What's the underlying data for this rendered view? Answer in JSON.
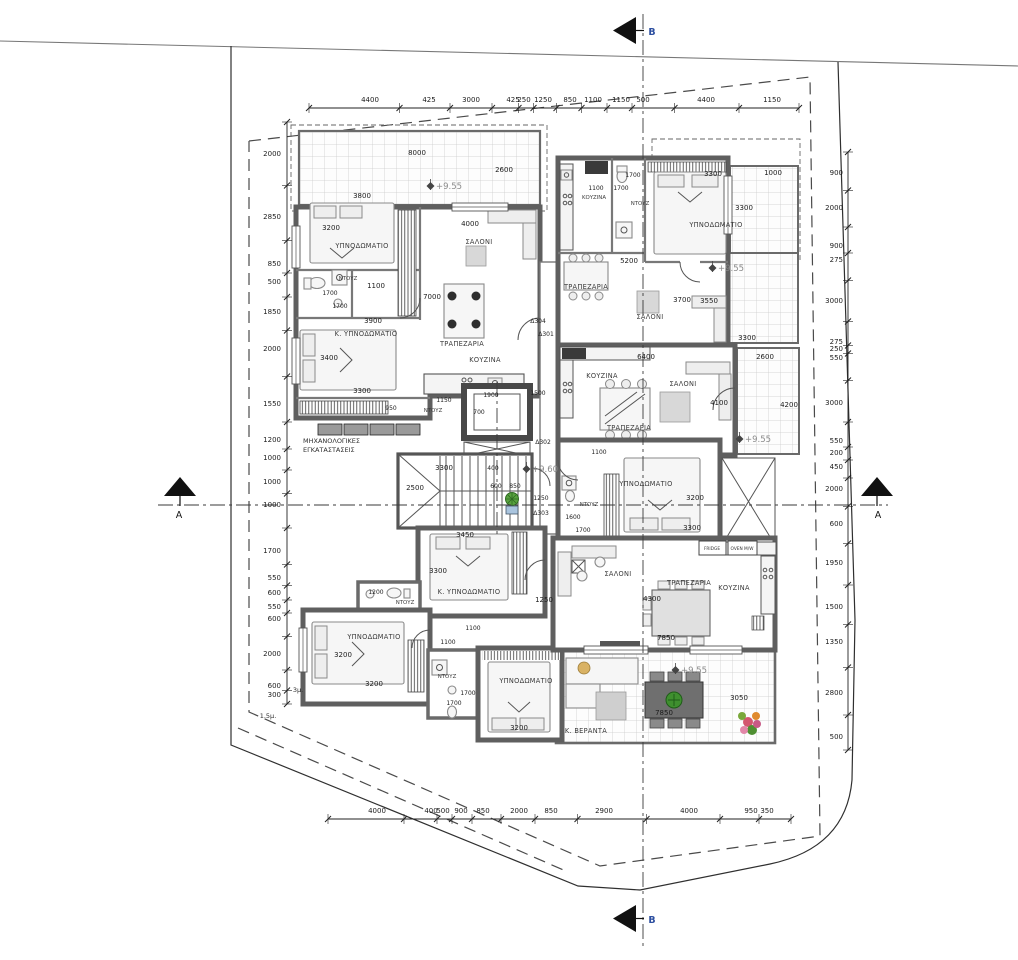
{
  "section_markers": {
    "top": "B",
    "bottom": "B",
    "left": "A",
    "right": "A"
  },
  "levels": [
    "+9.55",
    "+9.55",
    "+9.55",
    "+9.55",
    "+9.60"
  ],
  "door_tags": [
    "Δ304",
    "Δ301",
    "Δ302",
    "Δ303"
  ],
  "chains": {
    "top": {
      "o": "h",
      "line": 108,
      "lp": 102,
      "from": 309,
      "to": 799,
      "labels": [
        {
          "t": "4400",
          "p": 370
        },
        {
          "t": "425",
          "p": 429
        },
        {
          "t": "3000",
          "p": 471
        },
        {
          "t": "425",
          "p": 513
        },
        {
          "t": "250",
          "p": 524
        },
        {
          "t": "1250",
          "p": 543
        },
        {
          "t": "850",
          "p": 570
        },
        {
          "t": "1100",
          "p": 593
        },
        {
          "t": "1150",
          "p": 621
        },
        {
          "t": "500",
          "p": 643
        },
        {
          "t": "4400",
          "p": 706
        },
        {
          "t": "1150",
          "p": 772
        }
      ]
    },
    "bottom": {
      "o": "h",
      "line": 819,
      "lp": 813,
      "from": 328,
      "to": 791,
      "labels": [
        {
          "t": "4000",
          "p": 377
        },
        {
          "t": "400",
          "p": 431
        },
        {
          "t": "500",
          "p": 443
        },
        {
          "t": "900",
          "p": 461
        },
        {
          "t": "850",
          "p": 483
        },
        {
          "t": "2000",
          "p": 519
        },
        {
          "t": "850",
          "p": 551
        },
        {
          "t": "2900",
          "p": 604
        },
        {
          "t": "4000",
          "p": 689
        },
        {
          "t": "950",
          "p": 751
        },
        {
          "t": "350",
          "p": 767
        }
      ]
    },
    "left": {
      "o": "v",
      "line": 287,
      "lp": 281,
      "from": 122,
      "to": 704,
      "labels": [
        {
          "t": "2000",
          "p": 154
        },
        {
          "t": "2850",
          "p": 217
        },
        {
          "t": "850",
          "p": 264
        },
        {
          "t": "500",
          "p": 282
        },
        {
          "t": "1850",
          "p": 312
        },
        {
          "t": "2000",
          "p": 349
        },
        {
          "t": "1550",
          "p": 404
        },
        {
          "t": "1200",
          "p": 440
        },
        {
          "t": "1000",
          "p": 458
        },
        {
          "t": "1000",
          "p": 482
        },
        {
          "t": "1000",
          "p": 505
        },
        {
          "t": "1700",
          "p": 551
        },
        {
          "t": "550",
          "p": 578
        },
        {
          "t": "600",
          "p": 593
        },
        {
          "t": "550",
          "p": 607
        },
        {
          "t": "600",
          "p": 619
        },
        {
          "t": "2000",
          "p": 654
        },
        {
          "t": "600",
          "p": 686
        },
        {
          "t": "300",
          "p": 695
        }
      ]
    },
    "right": {
      "o": "v",
      "line": 848,
      "lp": 843,
      "from": 152,
      "to": 750,
      "labels": [
        {
          "t": "900",
          "p": 173
        },
        {
          "t": "2000",
          "p": 208
        },
        {
          "t": "900",
          "p": 246
        },
        {
          "t": "275",
          "p": 260
        },
        {
          "t": "3000",
          "p": 301
        },
        {
          "t": "275",
          "p": 342
        },
        {
          "t": "250",
          "p": 349
        },
        {
          "t": "550",
          "p": 358
        },
        {
          "t": "3000",
          "p": 403
        },
        {
          "t": "550",
          "p": 441
        },
        {
          "t": "200",
          "p": 453
        },
        {
          "t": "450",
          "p": 467
        },
        {
          "t": "2000",
          "p": 489
        },
        {
          "t": "600",
          "p": 524
        },
        {
          "t": "1950",
          "p": 563
        },
        {
          "t": "1500",
          "p": 607
        },
        {
          "t": "1350",
          "p": 642
        },
        {
          "t": "2800",
          "p": 693
        },
        {
          "t": "500",
          "p": 737
        }
      ]
    }
  },
  "labels": [
    {
      "t": "8000",
      "x": 417,
      "y": 155,
      "c": "d"
    },
    {
      "t": "2600",
      "x": 504,
      "y": 172,
      "c": "d"
    },
    {
      "t": "+9.55",
      "x": 449,
      "y": 189,
      "c": "lv"
    },
    {
      "t": "3800",
      "x": 362,
      "y": 198,
      "c": "d"
    },
    {
      "t": "3200",
      "x": 331,
      "y": 230,
      "c": "d"
    },
    {
      "t": "4000",
      "x": 470,
      "y": 226,
      "c": "d"
    },
    {
      "t": "ΥΠΝΟΔΩΜΑΤΙΟ",
      "x": 362,
      "y": 248,
      "c": "r"
    },
    {
      "t": "ΣΑΛΟΝΙ",
      "x": 479,
      "y": 244,
      "c": "r"
    },
    {
      "t": "ΝΤΟΥΖ",
      "x": 348,
      "y": 280,
      "c": "rs"
    },
    {
      "t": "1100",
      "x": 376,
      "y": 288,
      "c": "d"
    },
    {
      "t": "1700",
      "x": 330,
      "y": 295,
      "c": "ds"
    },
    {
      "t": "1700",
      "x": 340,
      "y": 308,
      "c": "ds"
    },
    {
      "t": "7000",
      "x": 432,
      "y": 299,
      "c": "d"
    },
    {
      "t": "3900",
      "x": 373,
      "y": 323,
      "c": "d"
    },
    {
      "t": "Δ304",
      "x": 538,
      "y": 323,
      "c": "tg"
    },
    {
      "t": "Δ301",
      "x": 546,
      "y": 336,
      "c": "tg"
    },
    {
      "t": "Κ. ΥΠΝΟΔΩΜΑΤΙΟ",
      "x": 366,
      "y": 336,
      "c": "r"
    },
    {
      "t": "ΤΡΑΠΕΖΑΡΙΑ",
      "x": 462,
      "y": 346,
      "c": "r"
    },
    {
      "t": "ΚΟΥΖΙΝΑ",
      "x": 485,
      "y": 362,
      "c": "r"
    },
    {
      "t": "3400",
      "x": 329,
      "y": 360,
      "c": "d"
    },
    {
      "t": "3300",
      "x": 362,
      "y": 393,
      "c": "d"
    },
    {
      "t": "950",
      "x": 391,
      "y": 410,
      "c": "ds"
    },
    {
      "t": "1150",
      "x": 444,
      "y": 402,
      "c": "ds"
    },
    {
      "t": "ΝΤΟΥΖ",
      "x": 433,
      "y": 412,
      "c": "rs"
    },
    {
      "t": "ΜΗΧΑΝΟΛΟΓΙΚΕΣ",
      "x": 303,
      "y": 443,
      "c": "n",
      "a": "start"
    },
    {
      "t": "ΕΓΚΑΤΑΣΤΑΣΕΙΣ",
      "x": 303,
      "y": 452,
      "c": "n",
      "a": "start"
    },
    {
      "t": "1500",
      "x": 538,
      "y": 395,
      "c": "ds"
    },
    {
      "t": "1100",
      "x": 596,
      "y": 190,
      "c": "ds"
    },
    {
      "t": "ΚΟΥΖΙΝΑ",
      "x": 594,
      "y": 199,
      "c": "rs"
    },
    {
      "t": "1700",
      "x": 633,
      "y": 177,
      "c": "ds"
    },
    {
      "t": "1700",
      "x": 621,
      "y": 190,
      "c": "ds"
    },
    {
      "t": "ΝΤΟΥΖ",
      "x": 640,
      "y": 205,
      "c": "rs"
    },
    {
      "t": "3300",
      "x": 713,
      "y": 176,
      "c": "d"
    },
    {
      "t": "1000",
      "x": 773,
      "y": 175,
      "c": "d"
    },
    {
      "t": "3300",
      "x": 744,
      "y": 210,
      "c": "d"
    },
    {
      "t": "ΥΠΝΟΔΩΜΑΤΙΟ",
      "x": 716,
      "y": 227,
      "c": "r"
    },
    {
      "t": "5200",
      "x": 629,
      "y": 263,
      "c": "d"
    },
    {
      "t": "+9.55",
      "x": 731,
      "y": 271,
      "c": "lv"
    },
    {
      "t": "ΤΡΑΠΕΖΑΡΙΑ",
      "x": 586,
      "y": 289,
      "c": "r"
    },
    {
      "t": "ΣΑΛΟΝΙ",
      "x": 650,
      "y": 319,
      "c": "r"
    },
    {
      "t": "3700",
      "x": 682,
      "y": 302,
      "c": "d"
    },
    {
      "t": "3550",
      "x": 709,
      "y": 303,
      "c": "d"
    },
    {
      "t": "3300",
      "x": 747,
      "y": 340,
      "c": "d"
    },
    {
      "t": "ΚΟΥΖΙΝΑ",
      "x": 602,
      "y": 378,
      "c": "r"
    },
    {
      "t": "6400",
      "x": 646,
      "y": 359,
      "c": "d"
    },
    {
      "t": "2600",
      "x": 765,
      "y": 359,
      "c": "d"
    },
    {
      "t": "ΣΑΛΟΝΙ",
      "x": 683,
      "y": 386,
      "c": "r"
    },
    {
      "t": "ΤΡΑΠΕΖΑΡΙΑ",
      "x": 629,
      "y": 430,
      "c": "r"
    },
    {
      "t": "4100",
      "x": 719,
      "y": 405,
      "c": "d"
    },
    {
      "t": "4200",
      "x": 789,
      "y": 407,
      "c": "d"
    },
    {
      "t": "+9.55",
      "x": 758,
      "y": 442,
      "c": "lv"
    },
    {
      "t": "1100",
      "x": 599,
      "y": 454,
      "c": "ds"
    },
    {
      "t": "ΥΠΝΟΔΩΜΑΤΙΟ",
      "x": 646,
      "y": 486,
      "c": "r"
    },
    {
      "t": "3200",
      "x": 695,
      "y": 500,
      "c": "d"
    },
    {
      "t": "3300",
      "x": 692,
      "y": 530,
      "c": "d"
    },
    {
      "t": "ΝΤΟΥΖ",
      "x": 589,
      "y": 506,
      "c": "rs"
    },
    {
      "t": "1600",
      "x": 573,
      "y": 519,
      "c": "ds"
    },
    {
      "t": "1700",
      "x": 583,
      "y": 532,
      "c": "ds"
    },
    {
      "t": "1900",
      "x": 491,
      "y": 397,
      "c": "ds"
    },
    {
      "t": "700",
      "x": 479,
      "y": 414,
      "c": "ds"
    },
    {
      "t": "3300",
      "x": 444,
      "y": 470,
      "c": "d"
    },
    {
      "t": "400",
      "x": 493,
      "y": 470,
      "c": "ds"
    },
    {
      "t": "2500",
      "x": 415,
      "y": 490,
      "c": "d"
    },
    {
      "t": "600",
      "x": 496,
      "y": 488,
      "c": "ds"
    },
    {
      "t": "850",
      "x": 515,
      "y": 488,
      "c": "ds"
    },
    {
      "t": "+9.60",
      "x": 545,
      "y": 472,
      "c": "lv"
    },
    {
      "t": "1250",
      "x": 541,
      "y": 500,
      "c": "ds"
    },
    {
      "t": "Δ302",
      "x": 543,
      "y": 444,
      "c": "tg"
    },
    {
      "t": "Δ303",
      "x": 541,
      "y": 515,
      "c": "tg"
    },
    {
      "t": "3450",
      "x": 465,
      "y": 537,
      "c": "d"
    },
    {
      "t": "3300",
      "x": 438,
      "y": 573,
      "c": "d"
    },
    {
      "t": "Κ. ΥΠΝΟΔΩΜΑΤΙΟ",
      "x": 469,
      "y": 594,
      "c": "r"
    },
    {
      "t": "1250",
      "x": 544,
      "y": 602,
      "c": "d"
    },
    {
      "t": "1200",
      "x": 376,
      "y": 594,
      "c": "ds"
    },
    {
      "t": "ΝΤΟΥΖ",
      "x": 405,
      "y": 604,
      "c": "rs"
    },
    {
      "t": "1100",
      "x": 473,
      "y": 630,
      "c": "ds"
    },
    {
      "t": "1100",
      "x": 448,
      "y": 644,
      "c": "ds"
    },
    {
      "t": "ΥΠΝΟΔΩΜΑΤΙΟ",
      "x": 374,
      "y": 639,
      "c": "r"
    },
    {
      "t": "3200",
      "x": 343,
      "y": 657,
      "c": "d"
    },
    {
      "t": "3200",
      "x": 374,
      "y": 686,
      "c": "d"
    },
    {
      "t": "ΝΤΟΥΖ",
      "x": 447,
      "y": 678,
      "c": "rs"
    },
    {
      "t": "1700",
      "x": 468,
      "y": 695,
      "c": "ds"
    },
    {
      "t": "1700",
      "x": 454,
      "y": 705,
      "c": "ds"
    },
    {
      "t": "ΥΠΝΟΔΩΜΑΤΙΟ",
      "x": 526,
      "y": 683,
      "c": "r"
    },
    {
      "t": "3200",
      "x": 519,
      "y": 730,
      "c": "d"
    },
    {
      "t": "3μ.",
      "x": 298,
      "y": 692,
      "c": "mu"
    },
    {
      "t": "1.5μ.",
      "x": 268,
      "y": 718,
      "c": "mu"
    },
    {
      "t": "ΣΑΛΟΝΙ",
      "x": 618,
      "y": 576,
      "c": "r"
    },
    {
      "t": "ΤΡΑΠΕΖΑΡΙΑ",
      "x": 689,
      "y": 585,
      "c": "r"
    },
    {
      "t": "ΚΟΥΖΙΝΑ",
      "x": 734,
      "y": 590,
      "c": "r"
    },
    {
      "t": "FRIDGE",
      "x": 712,
      "y": 550,
      "c": "xs"
    },
    {
      "t": "OVEN M/W",
      "x": 742,
      "y": 550,
      "c": "xs"
    },
    {
      "t": "4300",
      "x": 652,
      "y": 601,
      "c": "d"
    },
    {
      "t": "7850",
      "x": 666,
      "y": 640,
      "c": "d"
    },
    {
      "t": "+9.55",
      "x": 694,
      "y": 673,
      "c": "lv"
    },
    {
      "t": "3050",
      "x": 739,
      "y": 700,
      "c": "d"
    },
    {
      "t": "7850",
      "x": 664,
      "y": 715,
      "c": "d"
    },
    {
      "t": "Κ. ΒΕΡΑΝΤΑ",
      "x": 586,
      "y": 733,
      "c": "r"
    },
    {
      "t": "B",
      "x": 652,
      "y": 35,
      "c": "sb"
    },
    {
      "t": "B",
      "x": 652,
      "y": 923,
      "c": "sb"
    },
    {
      "t": "A",
      "x": 179,
      "y": 518,
      "c": "sa"
    },
    {
      "t": "A",
      "x": 878,
      "y": 518,
      "c": "sa"
    }
  ]
}
